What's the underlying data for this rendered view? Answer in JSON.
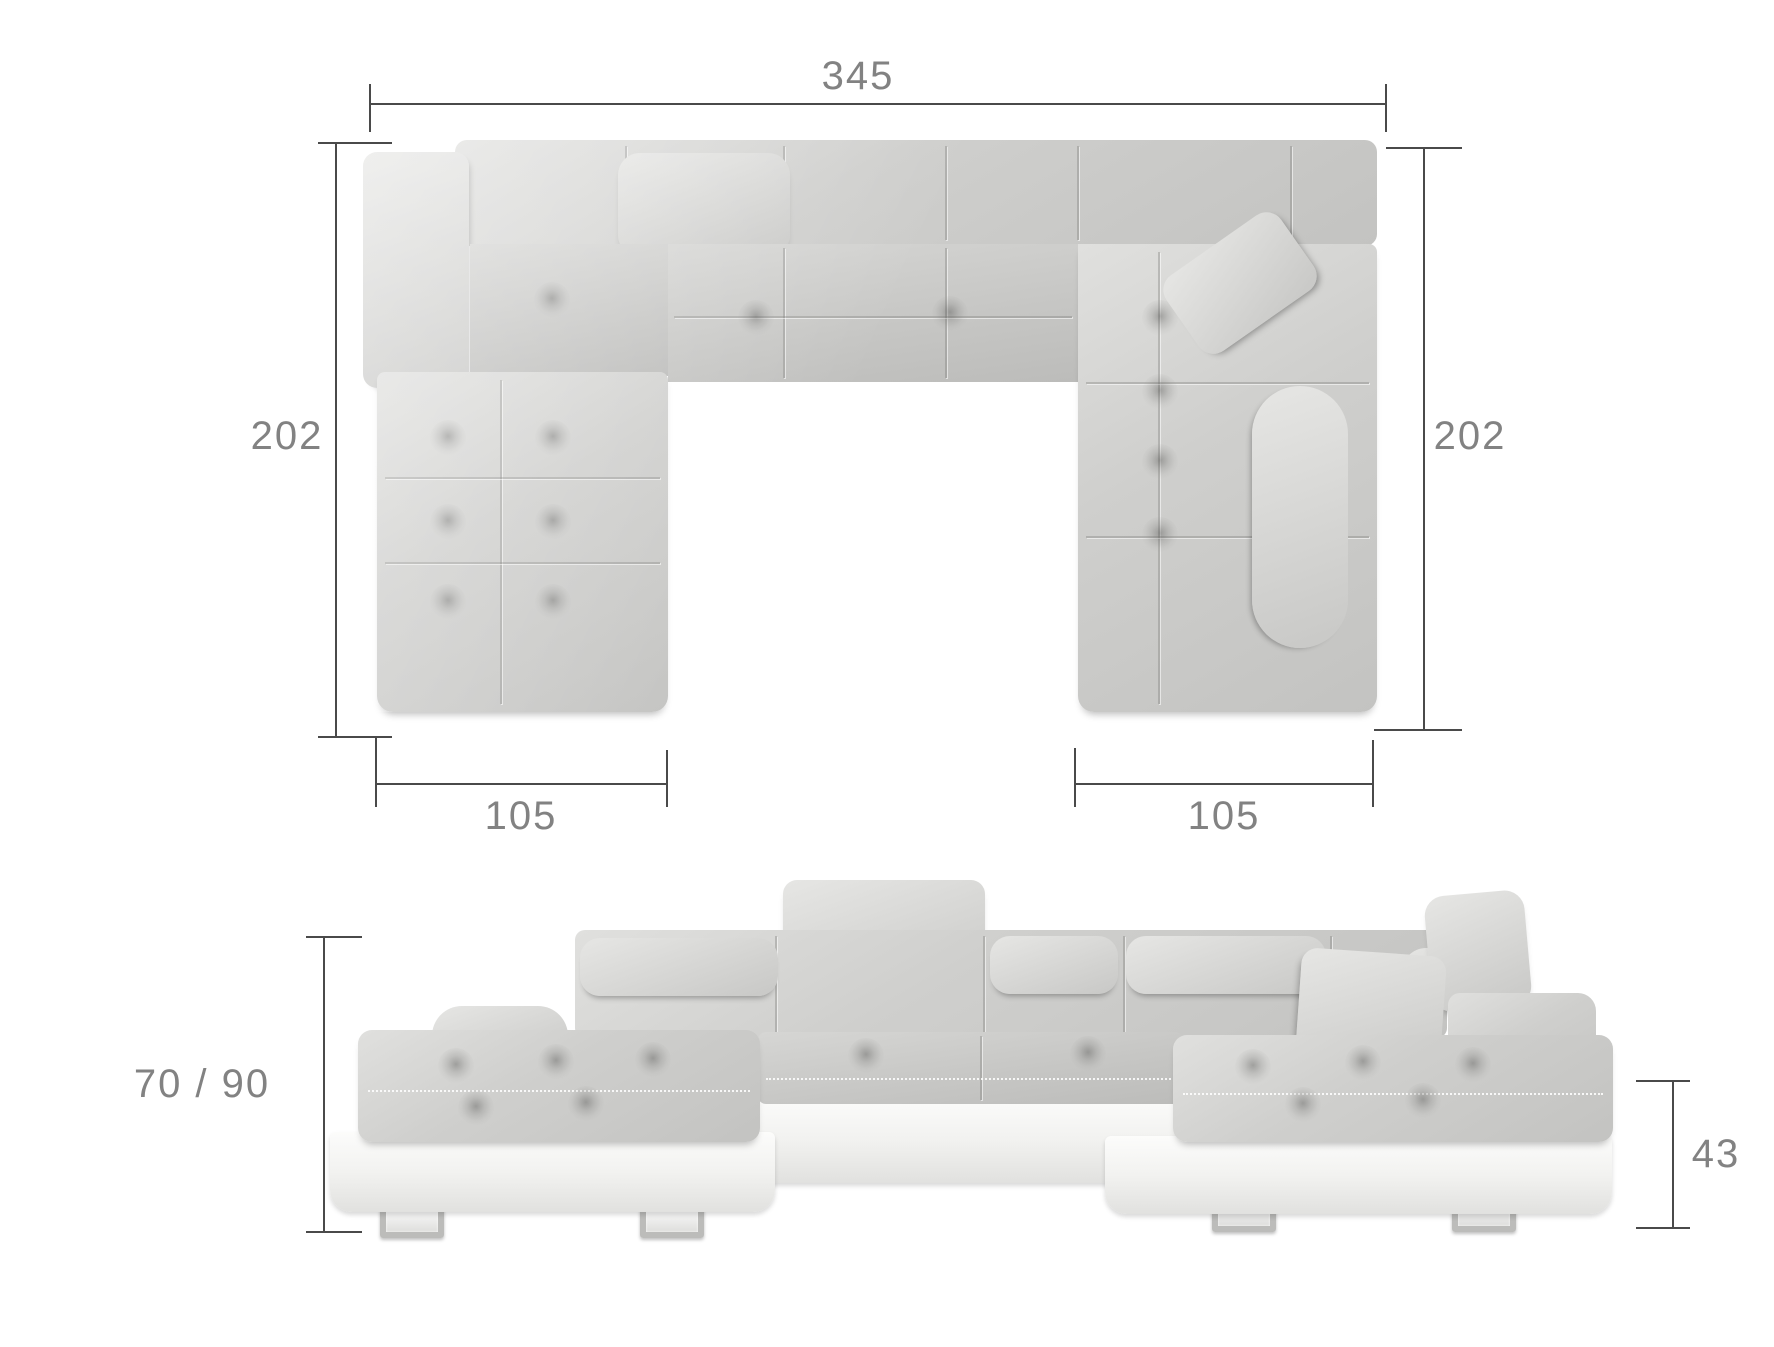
{
  "diagram": {
    "description": "U-shaped corner sofa dimension drawing: top (plan) view and front view",
    "colors": {
      "background": "#ffffff",
      "fabric": "#cfcfcd",
      "fabric_light": "#e0e0de",
      "fabric_dark": "#bcbcba",
      "base_white": "#f2f2f0",
      "leg_chrome": "#c9c9c7",
      "dimension_line": "#4a4a4a",
      "label_text": "#828282"
    },
    "top_view": {
      "width_total": "345",
      "depth_left": "202",
      "depth_right": "202",
      "chaise_left_width": "105",
      "chaise_right_width": "105"
    },
    "front_view": {
      "seat_and_backrest_height": "70 / 90",
      "base_height": "43"
    }
  }
}
